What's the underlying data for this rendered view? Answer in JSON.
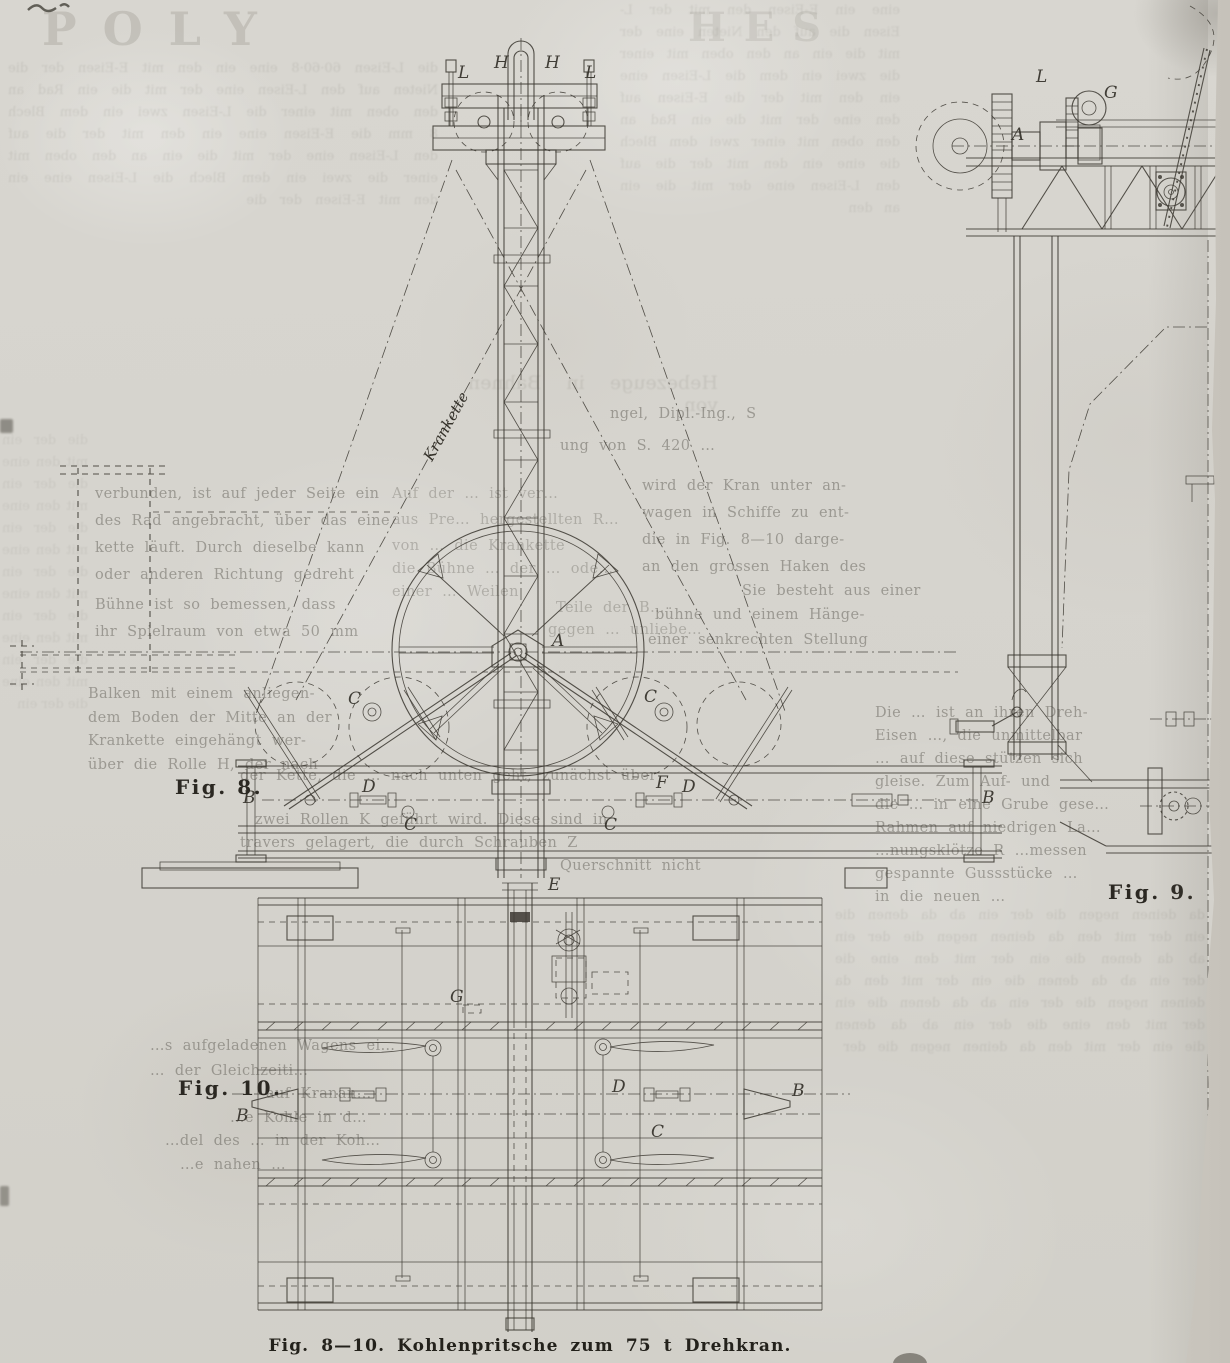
{
  "page": {
    "paper_color": "#d7d5cf",
    "ink_color": "#3d3a32",
    "caption": "Fig. 8—10. Kohlenpritsche zum 75 t Drehkran."
  },
  "figures": {
    "fig8": {
      "label": "Fig. 8.",
      "chain_label": "Krankette",
      "letters": {
        "l1": "L",
        "h1": "H",
        "h2": "H",
        "l2": "L",
        "a": "A",
        "c1": "C",
        "c2": "C",
        "c3": "C",
        "c4": "C",
        "d1": "D",
        "d2": "D",
        "f1": "F",
        "b1": "B",
        "b2": "B"
      }
    },
    "fig9": {
      "label": "Fig. 9.",
      "letters": {
        "l1": "L",
        "g1": "G",
        "a1": "A"
      }
    },
    "fig10": {
      "label": "Fig. 10.",
      "letters": {
        "e1": "E",
        "g1": "G",
        "d1": "D",
        "c1": "C",
        "b_left": "B",
        "b_right": "B"
      }
    }
  },
  "ghost": {
    "header": [
      "ngel, Dipl.-Ing., S",
      "ung von S. 420 …"
    ],
    "left_upper": [
      "verbunden, ist auf jeder Seite ein",
      "des Rad angebracht, über das eine",
      "kette läuft. Durch dieselbe kann",
      "oder anderen Richtung gedreht"
    ],
    "left_upper2": [
      "Bühne ist so bemessen, dass",
      "ihr Spielraum von etwa 50 mm"
    ],
    "left_mid": [
      "Balken mit einem anliegen-",
      "dem Boden der Mitte an der",
      "Krankette eingehängt wer-",
      "über die Rolle H, der nach"
    ],
    "left_wide": [
      "der Kette, die … nach unten geht, zunächst über",
      "zwei Rollen K geführt wird. Diese sind in",
      "travers gelagert, die durch Schrauben Z",
      "Querschnitt nicht"
    ],
    "right_upper": [
      "wird der Kran unter an-",
      "wagen in Schiffe zu ent-",
      "die in Fig. 8—10 darge-",
      "an den grossen Haken des",
      "Sie besteht aus einer",
      "bühne und einem Hänge-",
      "einer senkrechten Stellung"
    ],
    "right_fig9": [
      "Die … ist an ihren Dreh-",
      "Eisen …, die unmittelbar",
      "… auf diese stützen sich",
      "gleise.  Zum Auf- und",
      "die … in eine Grube gese…",
      "Rahmen auf niedrigen La…",
      "…nungsklötze R …messen",
      "gespannte Gussstücke …",
      "in die neuen …"
    ],
    "center_wheel": [
      "Auf der … ist ver…",
      "aus Pre… hergestellten R…",
      "von … die Krankette",
      "die Bühne … der … ode…",
      "einer … Weilen",
      "Teile der B…",
      "gegen … unliebe…"
    ],
    "bottom_left": [
      "…s aufgeladenen Wagens ei…",
      "… der Gleichzeiti…",
      "auf Kranan…",
      "…e Kohle in d…",
      "…del des … in der Koh…",
      "…e nahen …"
    ]
  },
  "bleedthrough": {
    "masthead_left": "POLY",
    "masthead_right": "HES",
    "header_ghost": "Hebezeuge in Bahnen von",
    "soup_a": "die L-Eisen 60·60·8 eine ein den mit E-Eisen der die Nieten auf den L-Eisen eine der mit die ein Rad an den oben mit einer die L-Eisen zwei ein dem Blech 8 mm die E-Eisen eine ein den mit der die auf den L-Eisen eine der mit die ein an den oben mit einer die zwei ein dem Blech die L-Eisen eine ein den mit E-Eisen der die",
    "soup_b": "eine ein E-Eisen den mit der L-Eisen die auf den Nieten eine der mit die ein an den oben mit einer die zwei ein dem die L-Eisen eine ein den mit der die E-Eisen auf den eine der mit die ein Rad an den oben mit einer zwei dem Blech die eine ein den mit der die auf den L-Eisen eine der mit die ein an den",
    "soup_c": "da deinen negen die der ein ab da denen die ein der mit den da deinen negen die der ein ab da denen die ein der mit den eine die der ein ab da denen die ein der mit den da deinen negen die der ein ab da denen die ein der mit den eine die der ein ab da denen die ein der mit den da deinen negen die der",
    "soup_d": "die der ein mit den eine die der ein mit den eine die der ein mit den eine die der ein mit den eine die der ein mit den eine die der ein mit den eine die der ein"
  }
}
